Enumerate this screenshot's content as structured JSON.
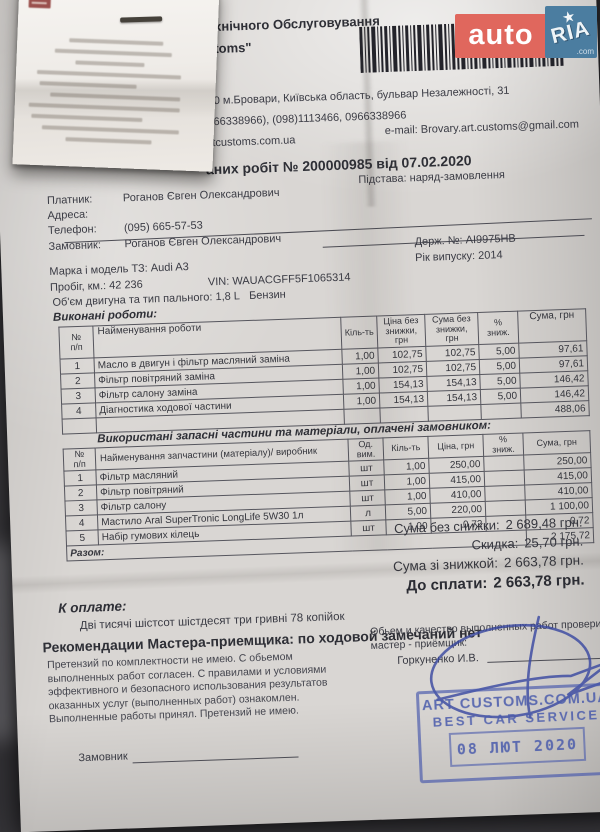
{
  "watermark": {
    "auto": "auto",
    "ria": "RIA",
    "star": "★",
    "com": ".com",
    "auto_bg": "#e0675d",
    "ria_bg": "#4b7da0"
  },
  "company": {
    "name_line1_fragment": "ія Технічного Обслуговування",
    "name_line2_fragment": "Customs\"",
    "address_fragment": "са:  07400 м.Бровари, Київська область, бульвар Незалежності, 31",
    "phone_fragment": "фон: (0966338966), (098)1113466, 0966338966",
    "website": "http://artcustoms.com.ua",
    "email": "e-mail: Brovary.art.customs@gmail.com"
  },
  "title_fragment": "аних робіт № 200000985 від 07.02.2020",
  "info": {
    "payer_label": "Платник:",
    "payer": "Роганов Євген Олександрович",
    "basis": "Підстава: наряд-замовлення",
    "address_label": "Адреса:",
    "phone_label": "Телефон:",
    "phone": "(095) 665-57-53",
    "customer_label": "Замовник:",
    "customer": "Роганов Євген Олександрович"
  },
  "vehicle": {
    "make_label": "Марка і модель ТЗ:",
    "make": "Audi A3",
    "plate_label": "Держ. №:",
    "plate": "AI9975HB",
    "mileage_label": "Пробіг, км.:",
    "mileage": "42 236",
    "vin_label": "VIN:",
    "vin": "WAUACGFF5F1065314",
    "year_label": "Рік випуску:",
    "year": "2014",
    "engine_label": "Об'єм двигуна та тип пального:",
    "engine": "1,8 L",
    "fuel": "Бензин"
  },
  "works": {
    "section_title": "Виконані роботи:",
    "headers": [
      "№\nп/п",
      "Найменування роботи",
      "Кіль-ть",
      "Ціна без\nзнижки,\nгрн",
      "Сума без\nзнижки,\nгрн",
      "%\nзниж.",
      "Сума, грн"
    ],
    "rows": [
      {
        "num": "1",
        "name": "Масло в двигун і фільтр масляний заміна",
        "qty": "1,00",
        "price": "102,75",
        "sum": "102,75",
        "disc": "5,00",
        "total": "97,61"
      },
      {
        "num": "2",
        "name": "Фільтр повітряний заміна",
        "qty": "1,00",
        "price": "102,75",
        "sum": "102,75",
        "disc": "5,00",
        "total": "97,61"
      },
      {
        "num": "3",
        "name": "Фільтр салону заміна",
        "qty": "1,00",
        "price": "154,13",
        "sum": "154,13",
        "disc": "5,00",
        "total": "146,42"
      },
      {
        "num": "4",
        "name": "Діагностика ходової частини",
        "qty": "1,00",
        "price": "154,13",
        "sum": "154,13",
        "disc": "5,00",
        "total": "146,42"
      }
    ],
    "total": "488,06"
  },
  "parts": {
    "section_title": "Використані запасні частини та матеріали, оплачені замовником:",
    "headers": [
      "№\nп/п",
      "Найменування запчастини (матеріалу)/ виробник",
      "Од.\nвим.",
      "Кіль-ть",
      "Ціна, грн",
      "%\nзниж.",
      "Сума, грн"
    ],
    "rows": [
      {
        "num": "1",
        "name": "Фільтр масляний",
        "unit": "шт",
        "qty": "1,00",
        "price": "250,00",
        "disc": "",
        "total": "250,00"
      },
      {
        "num": "2",
        "name": "Фільтр повітряний",
        "unit": "шт",
        "qty": "1,00",
        "price": "415,00",
        "disc": "",
        "total": "415,00"
      },
      {
        "num": "3",
        "name": "Фільтр салону",
        "unit": "шт",
        "qty": "1,00",
        "price": "410,00",
        "disc": "",
        "total": "410,00"
      },
      {
        "num": "4",
        "name": "Мастило Aral SuperTronic LongLife 5W30  1л",
        "unit": "л",
        "qty": "5,00",
        "price": "220,00",
        "disc": "",
        "total": "1 100,00"
      },
      {
        "num": "5",
        "name": "Набір гумових кілець",
        "unit": "шт",
        "qty": "1,00",
        "price": "0,72",
        "disc": "",
        "total": "0,72"
      }
    ],
    "total_label": "Разом:",
    "total": "2 175,72"
  },
  "totals": {
    "rows": [
      {
        "label": "Сума без снижки:",
        "value": "2 689,48 грн."
      },
      {
        "label": "Скидка:",
        "value": "25,70 грн."
      },
      {
        "label": "Сума зі знижкой:",
        "value": "2 663,78 грн."
      },
      {
        "label": "До сплати:",
        "value": "2 663,78 грн."
      }
    ]
  },
  "payment": {
    "label": "К оплате:",
    "amount_words": "Дві тисячі шістсот шістдесят три гривні 78 копійок"
  },
  "recommendations": "Рекомендации Мастера-приемщика: по ходовой замечаний нет",
  "disclaimer": [
    "Претензий по комплектности не имею. С обьемом",
    "выполненных работ согласен. С правилами и условиями",
    "эффективного и безопасного использования результатов",
    "оказанных услуг (выполненных работ) ознакомлен.",
    "Выполненные работы принял. Претензий не имею."
  ],
  "master": {
    "line1": "Обьем и качество выполненных работ проверил",
    "line2": "мастер - приёмщик:",
    "name": "Горкуненко И.В."
  },
  "stamp": {
    "line1": "ART CUSTOMS.COM.UA",
    "line2": "BEST CAR SERVICE",
    "date": "08 ЛЮТ 2020",
    "color": "#495aac"
  },
  "footer": {
    "customer_sign_label": "Замовник"
  }
}
